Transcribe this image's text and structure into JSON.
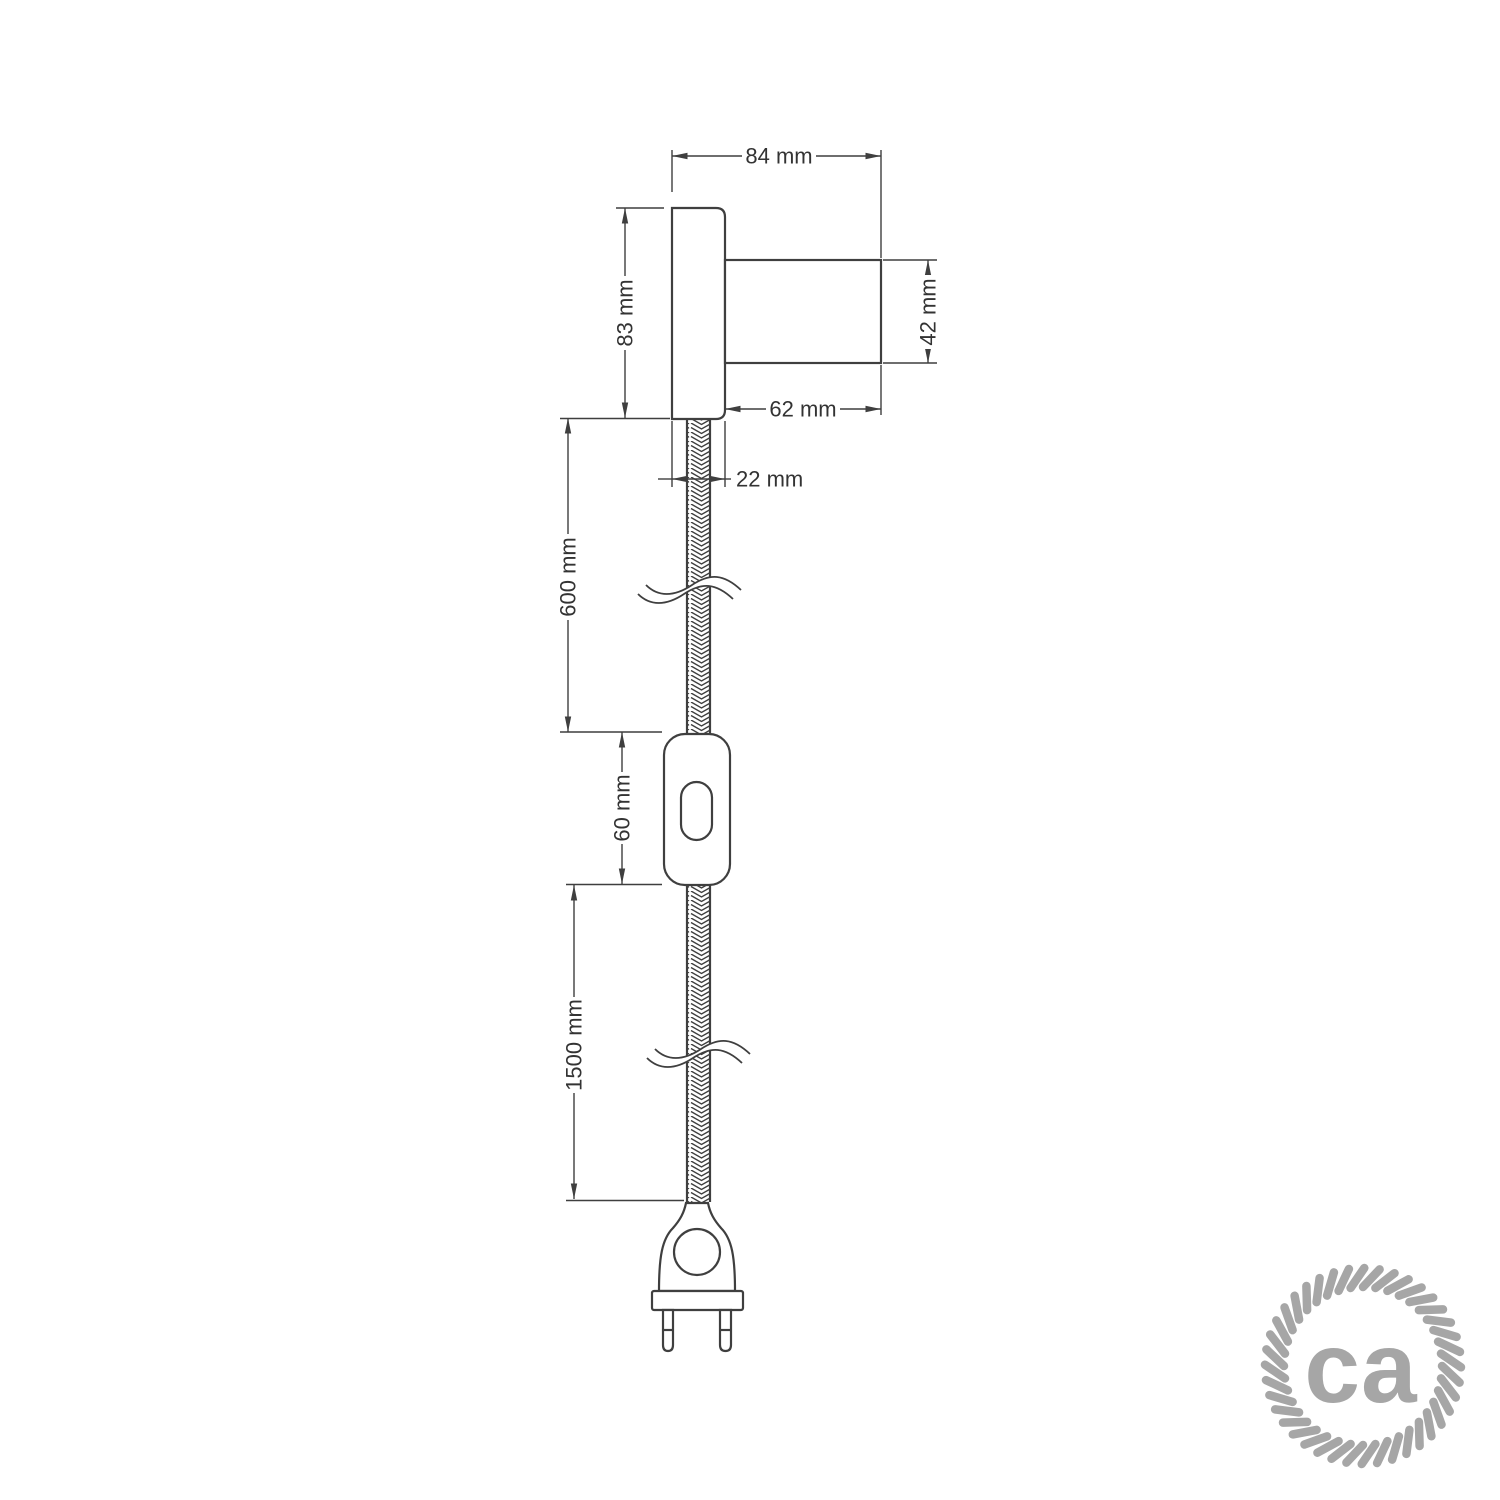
{
  "dims": {
    "total_width": "84 mm",
    "plate_height": "83 mm",
    "holder_diameter": "42 mm",
    "holder_length": "62 mm",
    "plate_depth": "22 mm",
    "upper_cable_length": "600 mm",
    "switch_length": "60 mm",
    "lower_cable_length": "1500 mm"
  },
  "logo": {
    "text": "ca"
  },
  "colors": {
    "line": "#3f3f3f",
    "text": "#333333",
    "logo_gray": "#a6a6a6",
    "background": "#ffffff"
  }
}
